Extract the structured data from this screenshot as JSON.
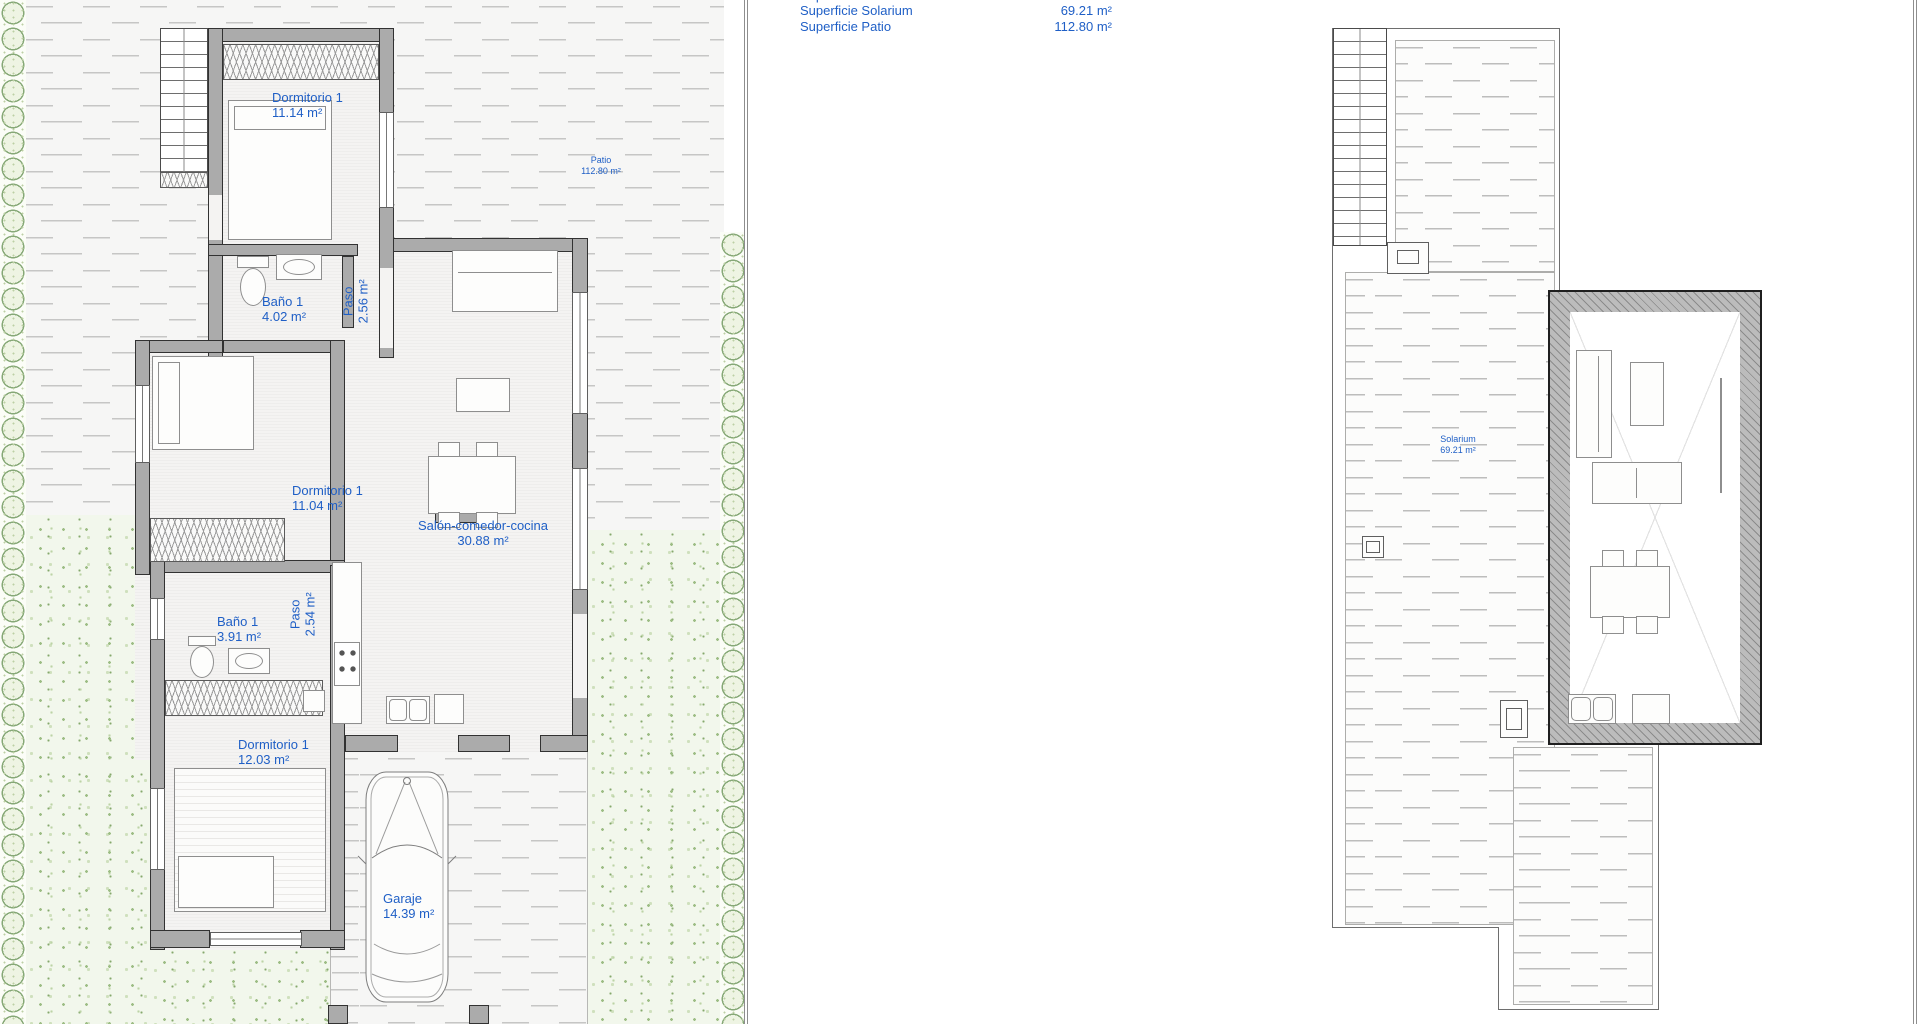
{
  "document_type": "architectural floor plans, ground floor and roof plan",
  "colors": {
    "label_blue": "#1f5fc6",
    "wall_gray": "#ababab"
  },
  "legend": {
    "clipped_row": {
      "label": "Superficie",
      "value": "m²"
    },
    "rows": [
      {
        "label": "Superficie Solarium",
        "value": "69.21 m²"
      },
      {
        "label": "Superficie Patio",
        "value": "112.80 m²"
      }
    ]
  },
  "ground_floor": {
    "rooms": [
      {
        "name": "Dormitorio 1",
        "area": "11.14 m²"
      },
      {
        "name": "Baño 1",
        "area": "4.02 m²"
      },
      {
        "name": "Paso",
        "area": "2.56 m²"
      },
      {
        "name": "Dormitorio 1",
        "area": "11.04 m²"
      },
      {
        "name": "Salón-comedor-cocina",
        "area": "30.88 m²"
      },
      {
        "name": "Baño 1",
        "area": "3.91 m²"
      },
      {
        "name": "Paso",
        "area": "2.54 m²"
      },
      {
        "name": "Dormitorio 1",
        "area": "12.03 m²"
      },
      {
        "name": "Garaje",
        "area": "14.39 m²"
      },
      {
        "name": "Patio",
        "area": "112.80 m²"
      }
    ]
  },
  "roof_plan": {
    "rooms": [
      {
        "name": "Solarium",
        "area": "69.21 m²"
      }
    ]
  }
}
